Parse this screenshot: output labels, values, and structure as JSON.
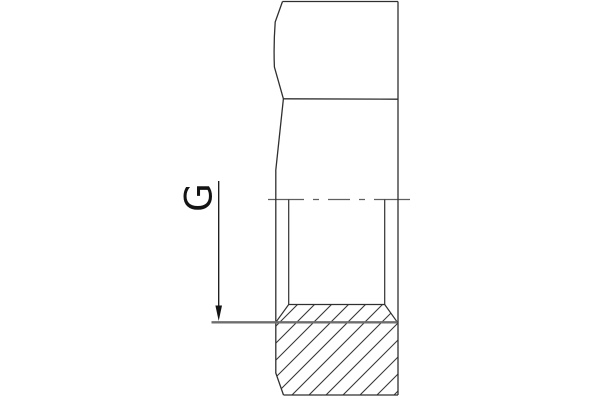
{
  "drawing": {
    "dimension_label": "G"
  },
  "colors": {
    "background": "#ffffff",
    "outline": "#2f2f2f",
    "face_edge": "#2f2f2f",
    "centerline": "#5f5f5f",
    "bore": "#303030",
    "thread_line": "#6e6e6e",
    "hatch": "#383838",
    "dimension": "#141414"
  }
}
